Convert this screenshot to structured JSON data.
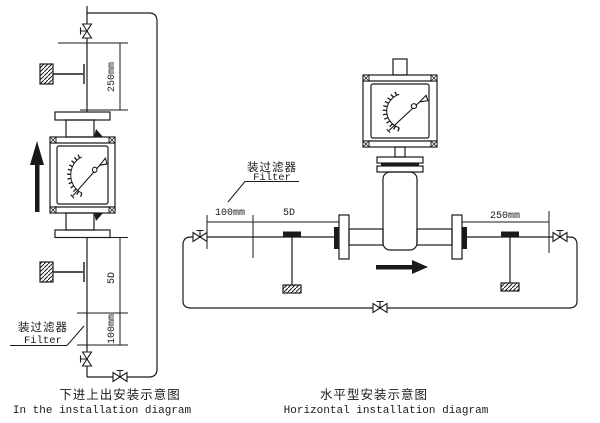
{
  "figure": {
    "bg_color": "#ffffff",
    "line_color": "#1a1a1a"
  },
  "vertical_diagram": {
    "caption_zh": "下进上出安装示意图",
    "caption_en": "In the installation diagram",
    "filter": {
      "zh": "装过滤器",
      "en": "Filter"
    },
    "dims": {
      "dim_250": "250mm",
      "dim_5d": "5D",
      "dim_100": "100mm"
    }
  },
  "horizontal_diagram": {
    "caption_zh": "水平型安装示意图",
    "caption_en": "Horizontal installation diagram",
    "filter": {
      "zh": "装过滤器",
      "en": "Filter"
    },
    "dims": {
      "dim_100": "100mm",
      "dim_5d": "5D",
      "dim_250": "250mm"
    }
  }
}
